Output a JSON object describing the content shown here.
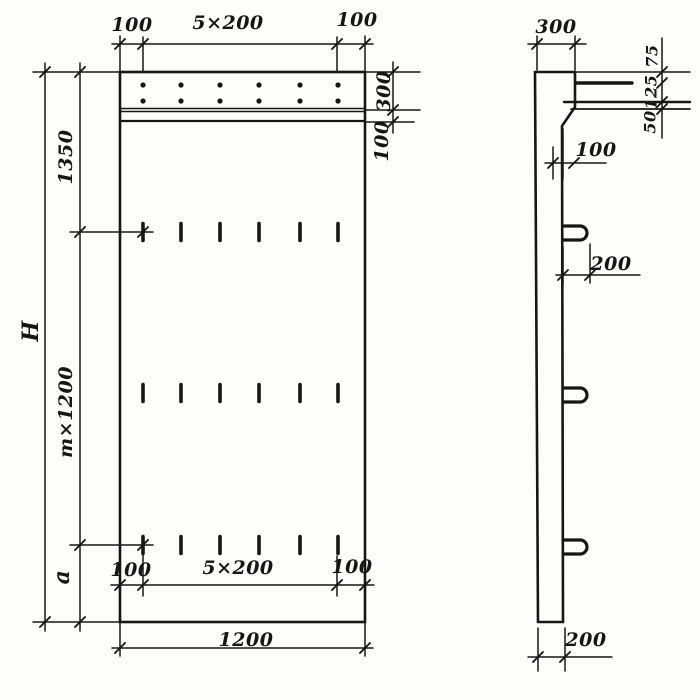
{
  "drawing_type": "panel elevation and section, dimensioned technical drawing",
  "front_view": {
    "top_dims": {
      "left_margin": "100",
      "hole_spacing": "5×200",
      "right_margin": "100"
    },
    "right_dims": {
      "band_height": "300",
      "strip_height": "100"
    },
    "left_dims": {
      "top_section": "1350",
      "total_height": "H",
      "middle_section": "m×1200",
      "bottom_section": "a"
    },
    "bottom_inner_dims": {
      "left_margin": "100",
      "slot_spacing": "5×200",
      "right_margin": "100"
    },
    "bottom_dims": {
      "overall_width": "1200"
    }
  },
  "side_view": {
    "top_dims": {
      "top_width": "300"
    },
    "right_dims": {
      "upper": "75",
      "middle": "125",
      "lower": "50"
    },
    "step_dims": {
      "step_offset": "100"
    },
    "loop_dims": {
      "loop_offset": "200"
    },
    "bottom_dims": {
      "thickness": "200"
    }
  },
  "colors": {
    "ink": "#161616",
    "paper": "#fdfdfb"
  }
}
